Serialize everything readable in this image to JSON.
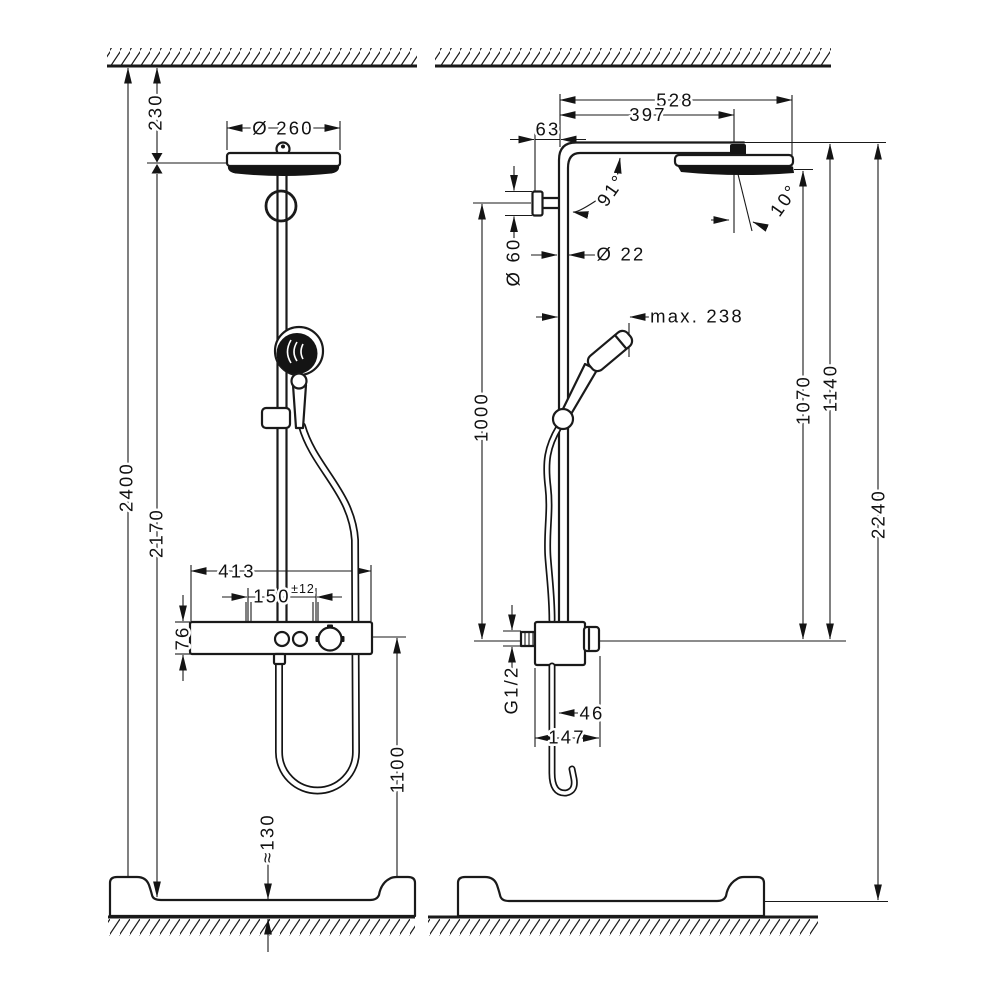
{
  "colors": {
    "line": "#1a1a1a",
    "background": "#ffffff",
    "fill_dark": "#141414"
  },
  "front": {
    "ceiling_offset": "230",
    "head_diameter": "Ø 260",
    "overall_height": "2400",
    "head_underside_height": "2170",
    "valve_width": "413",
    "inlet_spacing": "150",
    "inlet_tolerance": "±12",
    "valve_height": "76",
    "valve_center_height": "1100",
    "tray_step_height": "≈130"
  },
  "side": {
    "arm_projection": "528",
    "head_center_projection": "397",
    "wall_offset": "63",
    "arm_angle": "91°",
    "head_tilt": "10°",
    "escutcheon_diameter": "Ø 60",
    "pipe_diameter": "Ø 22",
    "handshower_projection": "max. 238",
    "bracket_to_valve": "1000",
    "head_bottom_height": "1070",
    "arm_top_height": "1140",
    "unit_height": "2240",
    "connection_thread": "G1/2",
    "hose_offset": "46",
    "valve_depth": "147"
  }
}
